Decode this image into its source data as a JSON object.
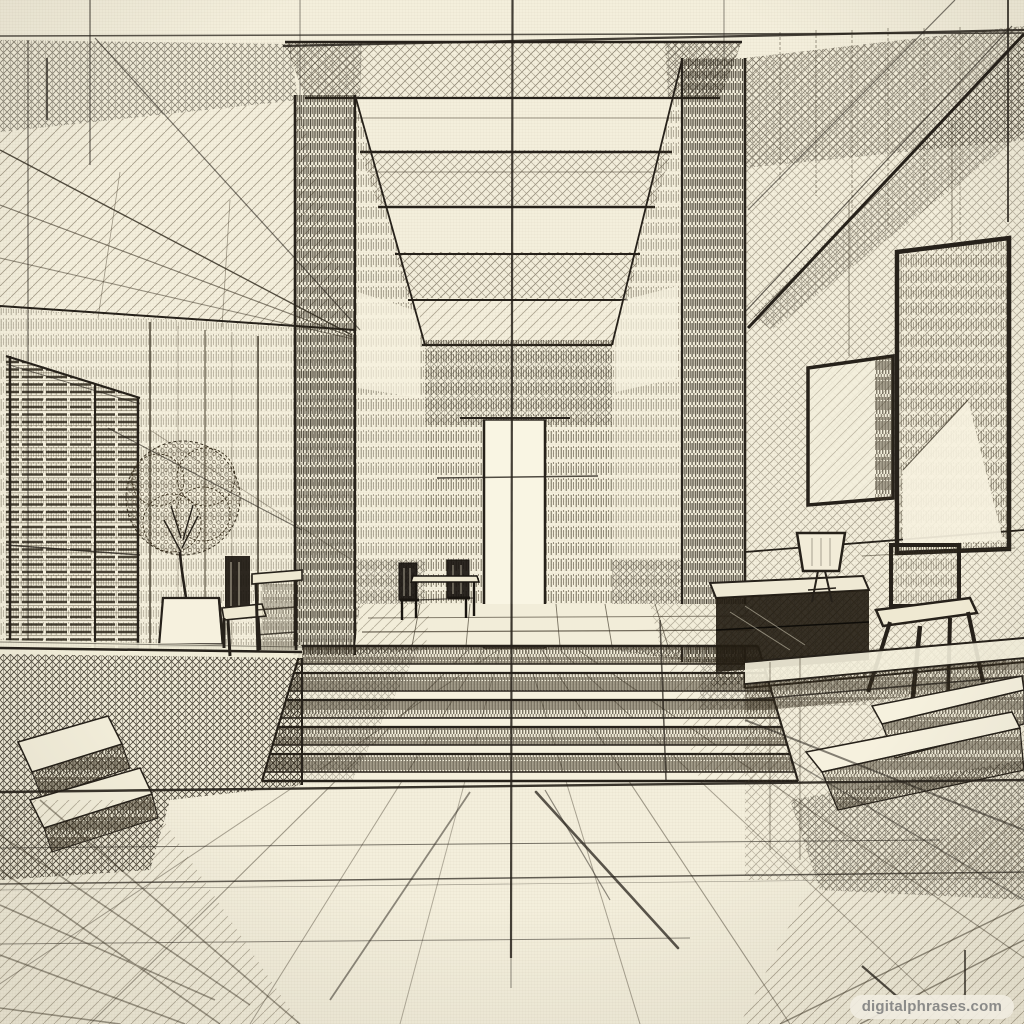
{
  "artwork": {
    "title": "Architectural interior perspective sketch",
    "medium": "pencil and ink hatching on cream paper",
    "description": "One-point perspective sketch of a double-height hallway with a skylit beamed ceiling, a bright far doorway, wide central steps, a left platform with window blinds, a potted tree, chairs and a table, and a right wall with framed panels, a sideboard with lamp, a stool with a small easel frame and corner steps.",
    "depicted_elements": [
      "skylight ceiling beams",
      "central corridor",
      "far bright doorway",
      "wide central steps",
      "window blinds",
      "potted tree in planter",
      "chair and table on left platform",
      "small table with chairs near doorway",
      "framed wall panels",
      "sideboard with table lamp",
      "stool with easel frame",
      "corner steps bottom right",
      "perspective floor lines",
      "construction lines"
    ]
  },
  "palette": {
    "paper": "#f4efdc",
    "ink_dark": "#26211a",
    "ink_mid": "#4a4234",
    "ink_light": "#8a7f6a",
    "highlight": "#f9f5e3"
  },
  "watermark": {
    "text": "digitalphrases.com",
    "text_color": "#8b8b89",
    "pill_background": "rgba(240,236,224,0.92)"
  }
}
